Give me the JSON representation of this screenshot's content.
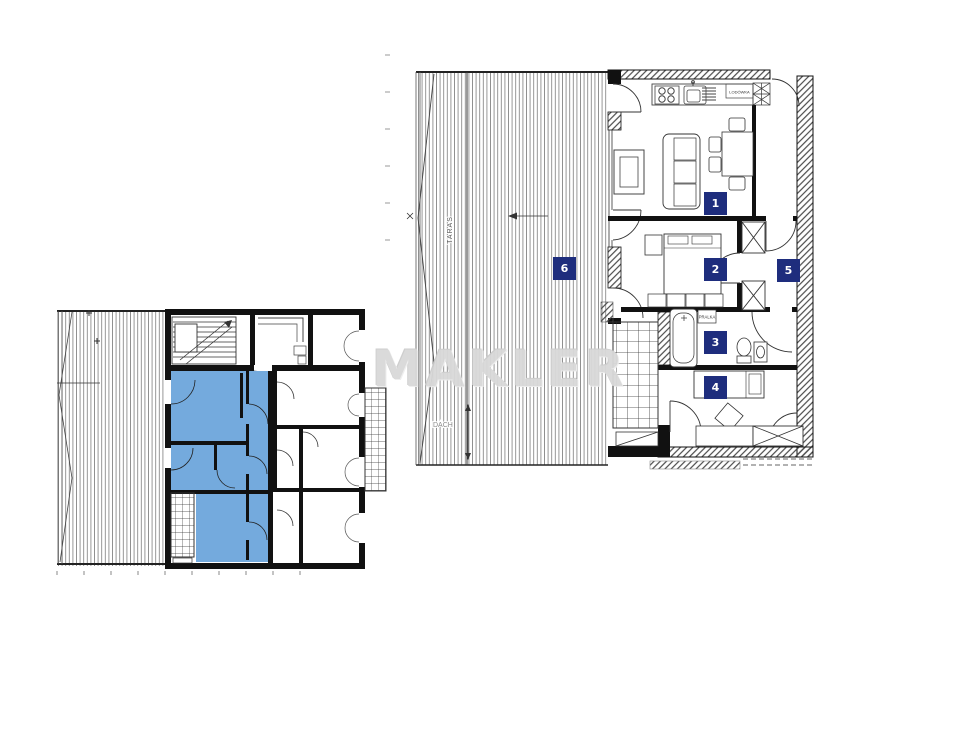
{
  "watermark": {
    "text": "MAKLER",
    "color": "#d9d9d9"
  },
  "detail_plan": {
    "terrace_label": "TARAS",
    "roof_label": "DACH",
    "washer_label": "PRALKA",
    "fridge_label": "LODÓWKA",
    "room_numbers": [
      "1",
      "2",
      "3",
      "4",
      "5",
      "6"
    ]
  },
  "overview_plan": {
    "highlighted_apartment_color": "#74aadd"
  },
  "colors": {
    "badge_bg": "#1e2d7d",
    "badge_text": "#ffffff",
    "wall": "#111111",
    "hatch_line": "#888888",
    "background": "#ffffff"
  }
}
